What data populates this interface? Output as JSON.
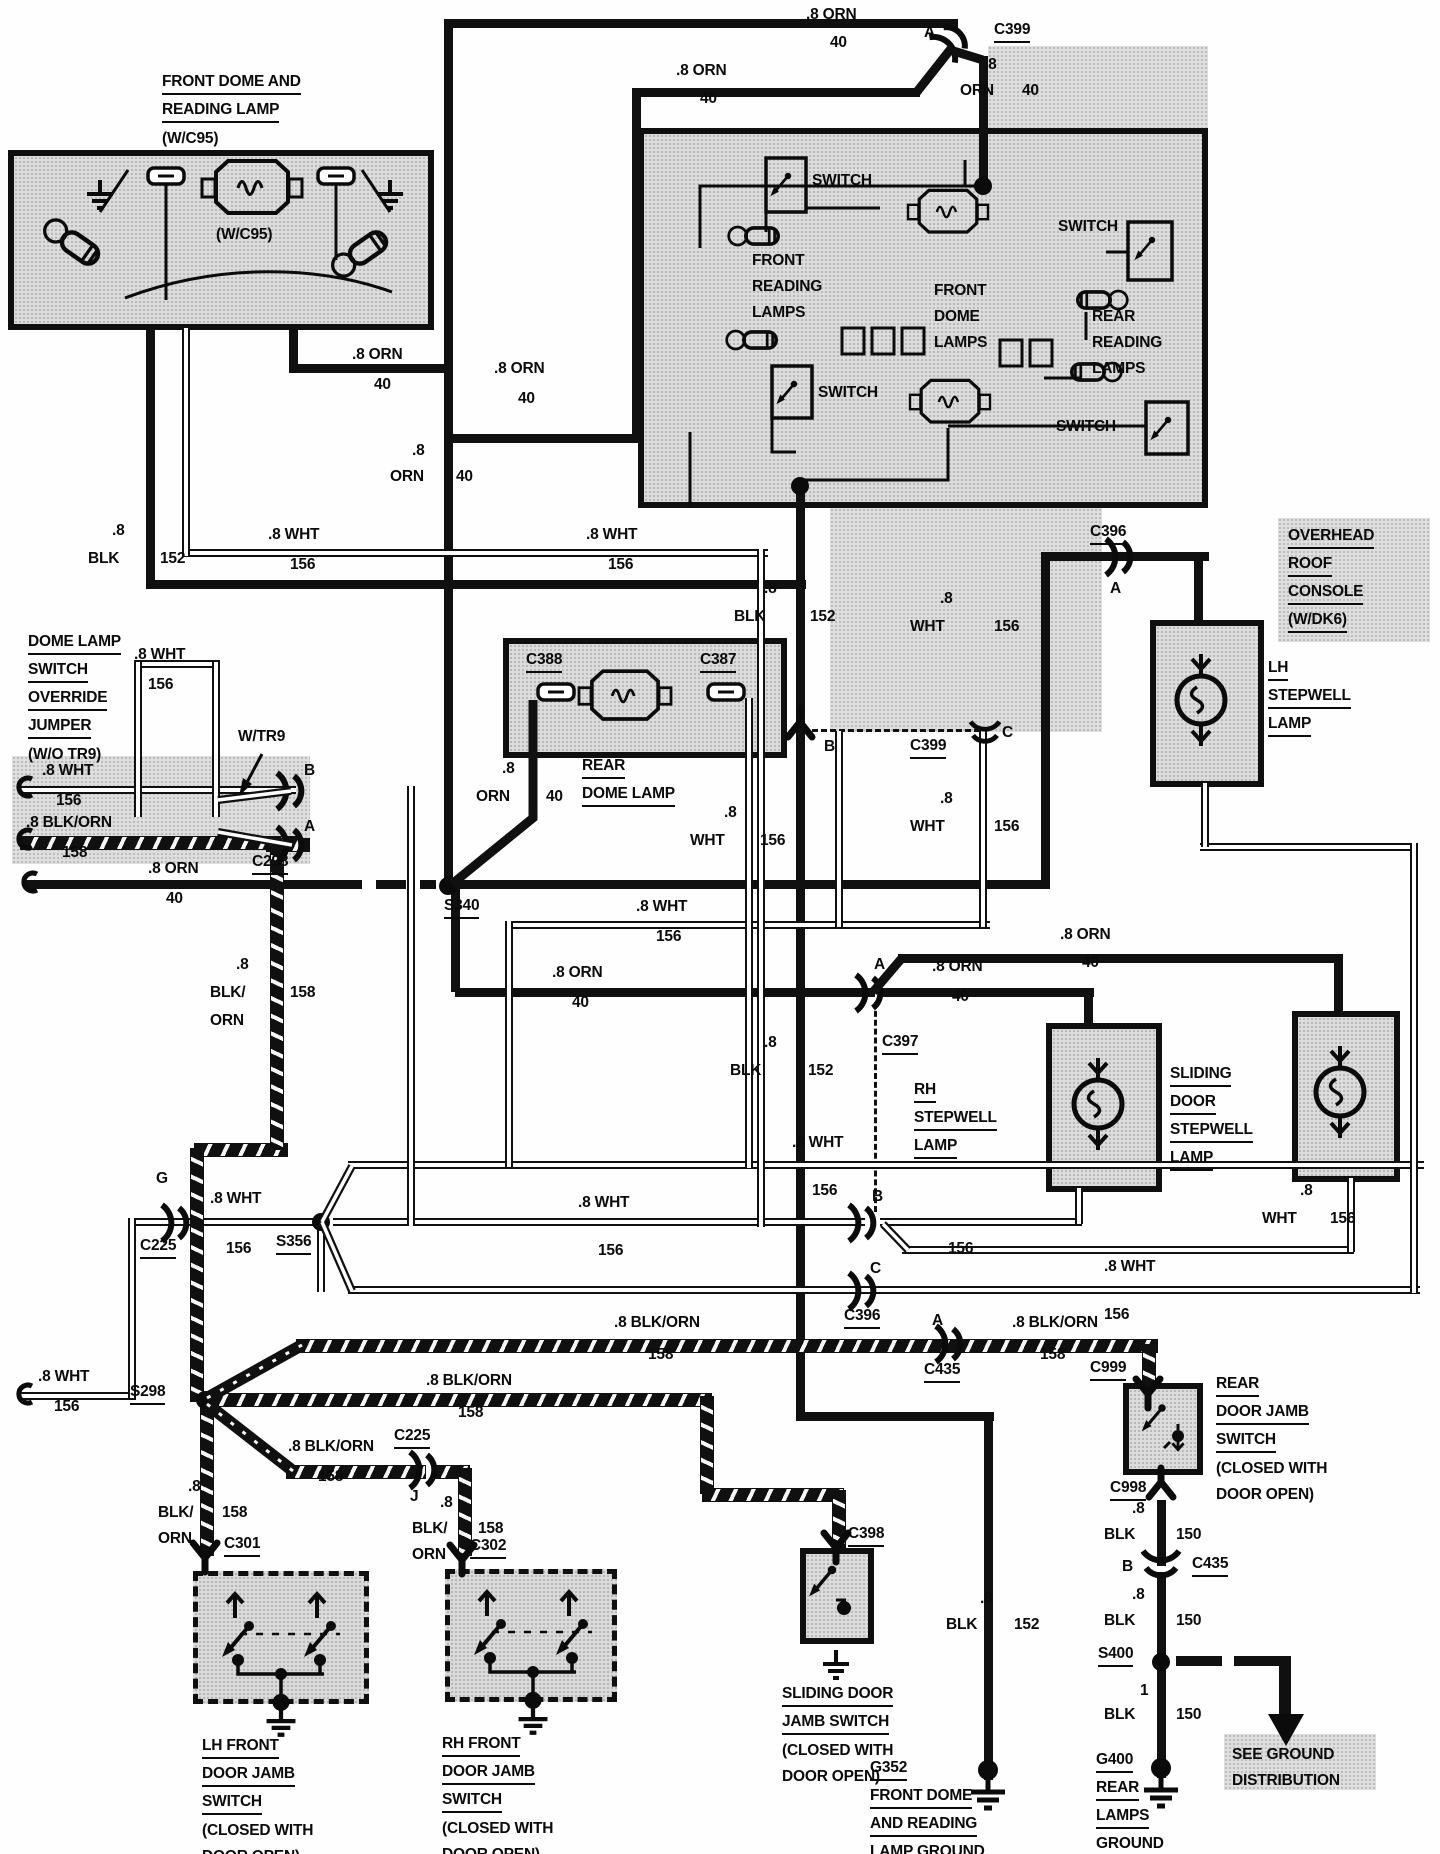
{
  "diagram_type": "automotive wiring diagram - dome and reading lamp circuit",
  "labels": {
    "fdrl": {
      "lines": [
        "FRONT DOME AND",
        "READING LAMP",
        "(W/C95)"
      ],
      "u": [
        0,
        1
      ]
    },
    "wc95i": {
      "lines": [
        "(W/C95)"
      ]
    },
    "l1": {
      "lines": [
        ".8 ORN"
      ]
    },
    "l2": {
      "lines": [
        "40"
      ]
    },
    "l3": {
      "lines": [
        ".8 ORN"
      ]
    },
    "l4": {
      "lines": [
        "40"
      ]
    },
    "l5": {
      "lines": [
        "A"
      ]
    },
    "l6": {
      "lines": [
        "C399"
      ],
      "u": [
        0
      ]
    },
    "l7": {
      "lines": [
        ".8"
      ]
    },
    "l8": {
      "lines": [
        "ORN"
      ]
    },
    "l9": {
      "lines": [
        "40"
      ]
    },
    "l10": {
      "lines": [
        ".8 ORN"
      ]
    },
    "l11": {
      "lines": [
        "40"
      ]
    },
    "l145": {
      "lines": [
        ".8 ORN"
      ]
    },
    "l146": {
      "lines": [
        "40"
      ]
    },
    "l12": {
      "lines": [
        ".8"
      ]
    },
    "l13": {
      "lines": [
        "ORN"
      ]
    },
    "l14": {
      "lines": [
        "40"
      ]
    },
    "l15": {
      "lines": [
        ".8"
      ]
    },
    "l16": {
      "lines": [
        "BLK"
      ]
    },
    "l17": {
      "lines": [
        "152"
      ]
    },
    "l18": {
      "lines": [
        ".8 WHT"
      ]
    },
    "l19": {
      "lines": [
        "156"
      ]
    },
    "l20": {
      "lines": [
        ".8 WHT"
      ]
    },
    "l21": {
      "lines": [
        "156"
      ]
    },
    "sw1": {
      "lines": [
        "SWITCH"
      ]
    },
    "sw2": {
      "lines": [
        "SWITCH"
      ]
    },
    "sw3": {
      "lines": [
        "SWITCH"
      ]
    },
    "sw4": {
      "lines": [
        "SWITCH"
      ]
    },
    "frl": {
      "lines": [
        "FRONT",
        "READING",
        "LAMPS"
      ]
    },
    "fdl": {
      "lines": [
        "FRONT",
        "DOME",
        "LAMPS"
      ]
    },
    "rrl": {
      "lines": [
        "REAR",
        "READING",
        "LAMPS"
      ]
    },
    "orc": {
      "lines": [
        "OVERHEAD",
        "ROOF",
        "CONSOLE",
        "(W/DK6)"
      ],
      "u": [
        0,
        1,
        2,
        3
      ]
    },
    "c396t": {
      "lines": [
        "C396"
      ],
      "u": [
        0
      ]
    },
    "ac396": {
      "lines": [
        "A"
      ]
    },
    "lsl": {
      "lines": [
        "LH",
        "STEPWELL",
        "LAMP"
      ],
      "u": [
        0,
        1,
        2
      ]
    },
    "dlsoj": {
      "lines": [
        "DOME LAMP",
        "SWITCH",
        "OVERRIDE",
        "JUMPER",
        "(W/O TR9)"
      ],
      "u": [
        0,
        1,
        2,
        3
      ]
    },
    "l31": {
      "lines": [
        ".8 WHT"
      ]
    },
    "l32": {
      "lines": [
        "156"
      ]
    },
    "l33": {
      "lines": [
        "W/TR9"
      ]
    },
    "l34": {
      "lines": [
        "B"
      ]
    },
    "l35": {
      "lines": [
        "A"
      ]
    },
    "l36": {
      "lines": [
        "C298"
      ],
      "u": [
        0
      ]
    },
    "l37": {
      "lines": [
        ".8 WHT"
      ]
    },
    "l38": {
      "lines": [
        "156"
      ]
    },
    "l39": {
      "lines": [
        ".8 BLK/ORN"
      ]
    },
    "l40": {
      "lines": [
        "158"
      ]
    },
    "l41": {
      "lines": [
        ".8 ORN"
      ]
    },
    "l42": {
      "lines": [
        "40"
      ]
    },
    "l43": {
      "lines": [
        "S340"
      ],
      "u": [
        0
      ]
    },
    "l44": {
      "lines": [
        "C388"
      ],
      "u": [
        0
      ]
    },
    "l45": {
      "lines": [
        "C387"
      ],
      "u": [
        0
      ]
    },
    "rdl": {
      "lines": [
        "REAR",
        "DOME LAMP"
      ],
      "u": [
        0,
        1
      ]
    },
    "l46": {
      "lines": [
        ".8"
      ]
    },
    "l47": {
      "lines": [
        "ORN"
      ]
    },
    "l48": {
      "lines": [
        "40"
      ]
    },
    "l49": {
      "lines": [
        ".8"
      ]
    },
    "l50": {
      "lines": [
        "WHT"
      ]
    },
    "l51": {
      "lines": [
        "156"
      ]
    },
    "l52": {
      "lines": [
        ".8"
      ]
    },
    "l53": {
      "lines": [
        "BLK"
      ]
    },
    "l54": {
      "lines": [
        "152"
      ]
    },
    "l55": {
      "lines": [
        ".8"
      ]
    },
    "l56": {
      "lines": [
        "WHT"
      ]
    },
    "l57": {
      "lines": [
        "156"
      ]
    },
    "l58": {
      "lines": [
        "B"
      ]
    },
    "l59": {
      "lines": [
        "C399"
      ],
      "u": [
        0
      ]
    },
    "l60": {
      "lines": [
        "C"
      ]
    },
    "l61": {
      "lines": [
        ".8"
      ]
    },
    "l62": {
      "lines": [
        "WHT"
      ]
    },
    "l63": {
      "lines": [
        "156"
      ]
    },
    "l64": {
      "lines": [
        ".8 WHT"
      ]
    },
    "l65": {
      "lines": [
        "156"
      ]
    },
    "l66": {
      "lines": [
        ".8 ORN"
      ]
    },
    "l67": {
      "lines": [
        "40"
      ]
    },
    "l68": {
      "lines": [
        ".8"
      ]
    },
    "l69": {
      "lines": [
        "BLK/"
      ]
    },
    "l70": {
      "lines": [
        "158"
      ]
    },
    "l71": {
      "lines": [
        "ORN"
      ]
    },
    "l72": {
      "lines": [
        "A"
      ]
    },
    "l73": {
      "lines": [
        "C397"
      ],
      "u": [
        0
      ]
    },
    "l74": {
      "lines": [
        ".8 ORN"
      ]
    },
    "l75": {
      "lines": [
        "40"
      ]
    },
    "l76": {
      "lines": [
        ".8 ORN"
      ]
    },
    "l77": {
      "lines": [
        "40"
      ]
    },
    "l78": {
      "lines": [
        ".8"
      ]
    },
    "l79": {
      "lines": [
        "BLK"
      ]
    },
    "l80": {
      "lines": [
        "152"
      ]
    },
    "rhsl": {
      "lines": [
        "RH",
        "STEPWELL",
        "LAMP"
      ],
      "u": [
        0,
        1,
        2
      ]
    },
    "sdsl": {
      "lines": [
        "SLIDING",
        "DOOR",
        "STEPWELL",
        "LAMP"
      ],
      "u": [
        0,
        1,
        2,
        3
      ]
    },
    "l81": {
      "lines": [
        ".8"
      ]
    },
    "l82": {
      "lines": [
        "WHT"
      ]
    },
    "l83": {
      "lines": [
        "156"
      ]
    },
    "l84": {
      "lines": [
        "G"
      ]
    },
    "l85": {
      "lines": [
        "C225"
      ],
      "u": [
        0
      ]
    },
    "l86": {
      "lines": [
        ".8 WHT"
      ]
    },
    "l87": {
      "lines": [
        "156"
      ]
    },
    "l88": {
      "lines": [
        "S356"
      ],
      "u": [
        0
      ]
    },
    "l89": {
      "lines": [
        ".8 WHT"
      ]
    },
    "l90": {
      "lines": [
        "156"
      ]
    },
    "l91": {
      "lines": [
        ".8 WHT"
      ]
    },
    "l92": {
      "lines": [
        "156"
      ]
    },
    "l93": {
      "lines": [
        "B"
      ]
    },
    "l94": {
      "lines": [
        "156"
      ]
    },
    "l95": {
      "lines": [
        ".8 WHT"
      ]
    },
    "l96": {
      "lines": [
        "156"
      ]
    },
    "l97": {
      "lines": [
        "C"
      ]
    },
    "l98": {
      "lines": [
        "C396"
      ],
      "u": [
        0
      ]
    },
    "l100": {
      "lines": [
        "A"
      ]
    },
    "l101": {
      "lines": [
        "C435"
      ],
      "u": [
        0
      ]
    },
    "l102": {
      "lines": [
        ".8 BLK/ORN"
      ]
    },
    "l103": {
      "lines": [
        "158"
      ]
    },
    "l104": {
      "lines": [
        ".8 BLK/ORN"
      ]
    },
    "l105": {
      "lines": [
        "158"
      ]
    },
    "l106": {
      "lines": [
        "C999"
      ],
      "u": [
        0
      ]
    },
    "rdjs": {
      "lines": [
        "REAR",
        "DOOR JAMB",
        "SWITCH",
        "(CLOSED WITH",
        "DOOR OPEN)"
      ],
      "u": [
        0,
        1,
        2
      ]
    },
    "l107": {
      "lines": [
        "C998"
      ],
      "u": [
        0
      ]
    },
    "l108": {
      "lines": [
        ".8"
      ]
    },
    "l109": {
      "lines": [
        "BLK"
      ]
    },
    "l110": {
      "lines": [
        "150"
      ]
    },
    "l111": {
      "lines": [
        "B"
      ]
    },
    "l112": {
      "lines": [
        "C435"
      ],
      "u": [
        0
      ]
    },
    "l113": {
      "lines": [
        ".8"
      ]
    },
    "l114": {
      "lines": [
        "BLK"
      ]
    },
    "l115": {
      "lines": [
        "150"
      ]
    },
    "l116": {
      "lines": [
        "S400"
      ],
      "u": [
        0
      ]
    },
    "l117": {
      "lines": [
        "1"
      ]
    },
    "l118": {
      "lines": [
        "BLK"
      ]
    },
    "l119": {
      "lines": [
        "150"
      ]
    },
    "g400": {
      "lines": [
        "G400",
        "REAR",
        "LAMPS",
        "GROUND"
      ],
      "u": [
        0,
        1,
        2,
        3
      ]
    },
    "sgd": {
      "lines": [
        "SEE GROUND",
        "DISTRIBUTION"
      ]
    },
    "l120": {
      "lines": [
        ".8 WHT"
      ]
    },
    "l121": {
      "lines": [
        "156"
      ]
    },
    "l122": {
      "lines": [
        "S298"
      ],
      "u": [
        0
      ]
    },
    "l123": {
      "lines": [
        ".8 BLK/ORN"
      ]
    },
    "l124": {
      "lines": [
        "158"
      ]
    },
    "l125": {
      "lines": [
        ".8 BLK/ORN"
      ]
    },
    "l126": {
      "lines": [
        "158"
      ]
    },
    "l127": {
      "lines": [
        "C225"
      ],
      "u": [
        0
      ]
    },
    "l128": {
      "lines": [
        "J"
      ]
    },
    "l129": {
      "lines": [
        ".8"
      ]
    },
    "l130": {
      "lines": [
        "BLK/"
      ]
    },
    "l131": {
      "lines": [
        "158"
      ]
    },
    "l132": {
      "lines": [
        "ORN"
      ]
    },
    "l133": {
      "lines": [
        ".8"
      ]
    },
    "l134": {
      "lines": [
        "BLK/"
      ]
    },
    "l135": {
      "lines": [
        "158"
      ]
    },
    "l136": {
      "lines": [
        "ORN"
      ]
    },
    "l137": {
      "lines": [
        "C301"
      ],
      "u": [
        0
      ]
    },
    "l138": {
      "lines": [
        "C302"
      ],
      "u": [
        0
      ]
    },
    "lhjs": {
      "lines": [
        "LH FRONT",
        "DOOR JAMB",
        "SWITCH",
        "(CLOSED WITH",
        "DOOR OPEN)"
      ],
      "u": [
        0,
        1,
        2
      ]
    },
    "rhjs": {
      "lines": [
        "RH FRONT",
        "DOOR JAMB",
        "SWITCH",
        "(CLOSED WITH",
        "DOOR OPEN)"
      ],
      "u": [
        0,
        1,
        2
      ]
    },
    "l139": {
      "lines": [
        "C398"
      ],
      "u": [
        0
      ]
    },
    "sdjs": {
      "lines": [
        "SLIDING DOOR",
        "JAMB SWITCH",
        "(CLOSED WITH",
        "DOOR OPEN)"
      ],
      "u": [
        0,
        1
      ]
    },
    "l140": {
      "lines": [
        ".8"
      ]
    },
    "l141": {
      "lines": [
        "BLK"
      ]
    },
    "l142": {
      "lines": [
        "152"
      ]
    },
    "g352": {
      "lines": [
        "G352",
        "FRONT DOME",
        "AND READING",
        "LAMP GROUND"
      ],
      "u": [
        0,
        1,
        2,
        3
      ]
    }
  },
  "connectors": [
    "C399",
    "C398",
    "C397",
    "C396",
    "C435",
    "C999",
    "C998",
    "C301",
    "C302",
    "C225",
    "C298",
    "C388",
    "C387"
  ],
  "splices": [
    "S340",
    "S356",
    "S298",
    "S400"
  ],
  "grounds": [
    "G352",
    "G400"
  ],
  "colors": {
    "ink": "#0b0b0b",
    "paper": "#fefefe",
    "shade": "#dcdcdc"
  }
}
